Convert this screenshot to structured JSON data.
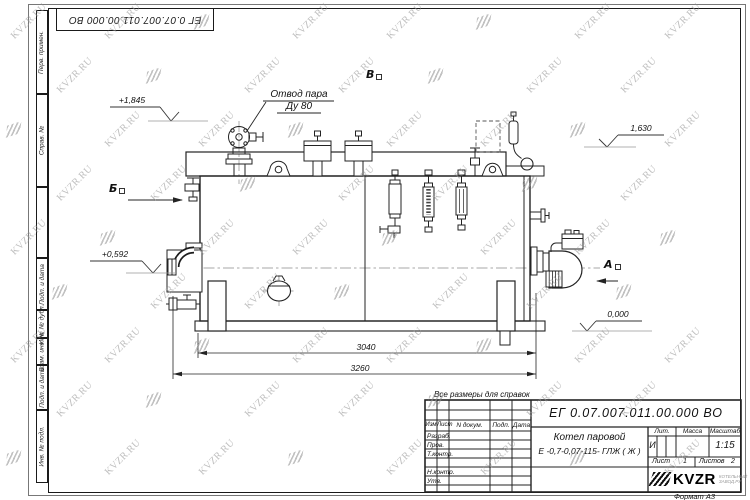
{
  "watermark": {
    "text": "KVZR.RU"
  },
  "stamp_top": {
    "doc_number": "ЕГ 0.07.007.011.00.000  ВО"
  },
  "margin": {
    "col1": "Перв. примен.",
    "col2": "Справ. №",
    "col3": "Подп. и дата",
    "col4": "Инв. № дубл.",
    "col5": "Взам. инв. №",
    "col6": "Подп. и дата",
    "col7": "Инв. № подл."
  },
  "drawing": {
    "callout_line1": "Отвод пара",
    "callout_line2": "Ду 80",
    "elev_top_left": "+1,845",
    "elev_top_right": "1,630",
    "elev_mid_left": "+0,592",
    "elev_ground": "0,000",
    "view_b": "Б",
    "view_v": "В",
    "view_a": "А",
    "dim_inner": "3040",
    "dim_outer": "3260",
    "note": "Все размеры для справок"
  },
  "title_block": {
    "doc_number": "ЕГ 0.07.007.011.00.000  ВО",
    "name_line1": "Котел паровой",
    "name_line2": "Е -0,7-0,07-115- ГЛЖ ( Ж )",
    "col_izm": "Изм",
    "col_list": "Лист",
    "col_ndoc": "N докум.",
    "col_podp": "Подп.",
    "col_data": "Дата",
    "row_razrab": "Разраб.",
    "row_prov": "Пров.",
    "row_tkontr": "Т.контр.",
    "row_nkontr": "Н.контр.",
    "row_utv": "Утв.",
    "lit_label": "Лит.",
    "mass_label": "Масса",
    "scale_label": "Масштаб",
    "lit_value": "И",
    "scale_value": "1:15",
    "sheet_label": "Лист",
    "sheet_value": "1",
    "sheets_label": "Листов",
    "sheets_value": "2",
    "logo_text": "KVZR",
    "logo_sub1": "КОТЕЛЬНЫЙ",
    "logo_sub2": "ЗАВОД.РУ",
    "format_label": "Формат А3"
  }
}
